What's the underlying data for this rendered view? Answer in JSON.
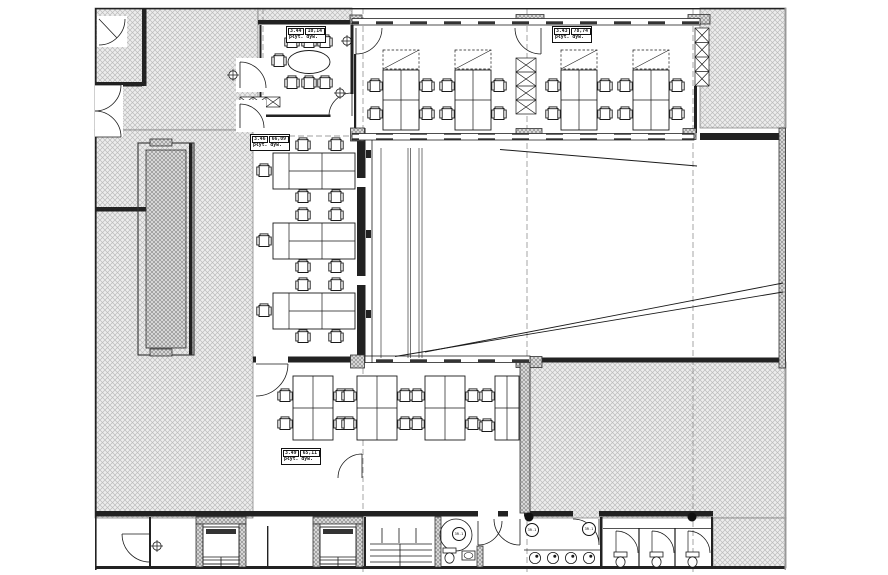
{
  "plan": {
    "colors": {
      "line": "#1a1a1a",
      "wall": "#222222",
      "hatch_bg": "#ededed",
      "hatch_line": "#bcbcbc",
      "background": "#ffffff"
    },
    "rooms": [
      {
        "key": "meeting-room",
        "id": "3.44",
        "area": "10,14",
        "finish": "płyt. dyw."
      },
      {
        "key": "open-office-north",
        "id": "3.43",
        "area": "78,74",
        "finish": "płyt. dyw."
      },
      {
        "key": "open-office-west",
        "id": "3.46",
        "area": "66,09",
        "finish": "płyt. dyw."
      },
      {
        "key": "open-office-south",
        "id": "3.49",
        "area": "65,11",
        "finish": "płyt. dyw."
      }
    ],
    "door_tags": [
      {
        "label": "3R.1"
      },
      {
        "label": "3R.1"
      },
      {
        "label": "3R.1"
      }
    ]
  }
}
